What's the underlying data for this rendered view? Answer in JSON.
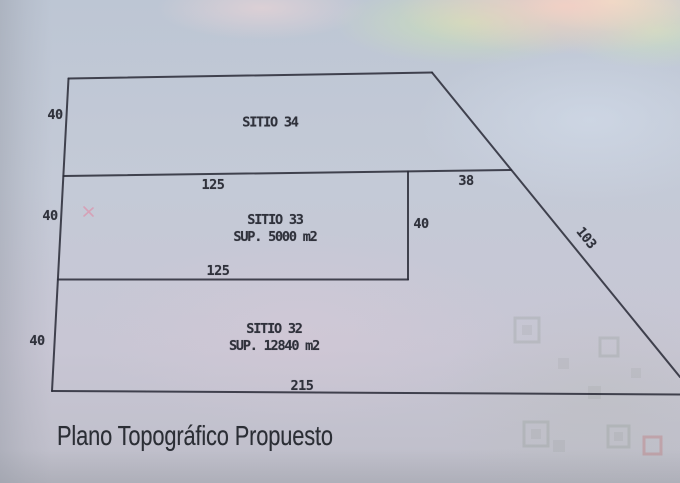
{
  "caption": {
    "text": "Plano Topográfico Propuesto"
  },
  "plan": {
    "sites": [
      {
        "name": "SITIO 34",
        "area": ""
      },
      {
        "name": "SITIO 33",
        "area": "SUP. 5000 m2"
      },
      {
        "name": "SITIO 32",
        "area": "SUP. 12840 m2"
      }
    ],
    "dims": {
      "sitio34_left": "40",
      "sitio33_left": "40",
      "sitio32_left": "40",
      "sitio33_top": "125",
      "sitio33_bottom": "125",
      "sitio33_right": "40",
      "top_right_segment": "38",
      "diagonal_side": "103",
      "bottom_side": "215"
    }
  },
  "colors": {
    "paper_base": "#c4cad7",
    "paper_lavender": "#c8c4d4",
    "tint_pink": "#f2cfc6",
    "tint_green": "#cde4b2",
    "line": "#2c2e3a",
    "text": "#2f313b",
    "caption_text": "#2b2e35"
  }
}
